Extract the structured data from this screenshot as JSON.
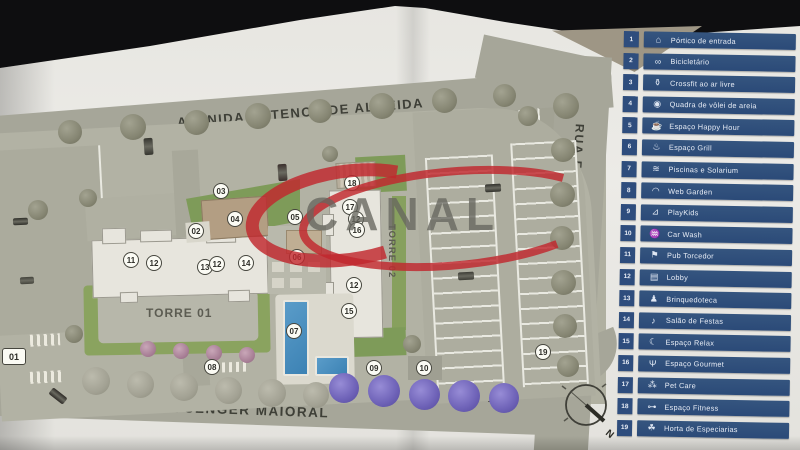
{
  "map": {
    "avenue_label": "AVENIDA ANTENOR DE ALMEIDA",
    "right_street_label": "RUA FIORAVANTE PISSUTTO",
    "bottom_street_label": "RUA REGINA SENGER MAIORAL",
    "tower1_label": "TORRE 01",
    "tower2_label": "TORRE 02",
    "compass_label": "N",
    "markers": [
      {
        "n": "01",
        "x": 14,
        "y": 356,
        "shape": "square"
      },
      {
        "n": "02",
        "x": 196,
        "y": 231
      },
      {
        "n": "03",
        "x": 221,
        "y": 191
      },
      {
        "n": "04",
        "x": 235,
        "y": 219
      },
      {
        "n": "05",
        "x": 295,
        "y": 217
      },
      {
        "n": "06",
        "x": 297,
        "y": 257
      },
      {
        "n": "07",
        "x": 294,
        "y": 331
      },
      {
        "n": "08",
        "x": 212,
        "y": 367
      },
      {
        "n": "09",
        "x": 374,
        "y": 368
      },
      {
        "n": "10",
        "x": 424,
        "y": 368
      },
      {
        "n": "11",
        "x": 131,
        "y": 260
      },
      {
        "n": "12",
        "x": 154,
        "y": 263
      },
      {
        "n": "13",
        "x": 205,
        "y": 267
      },
      {
        "n": "12",
        "x": 217,
        "y": 264
      },
      {
        "n": "14",
        "x": 246,
        "y": 263
      },
      {
        "n": "18",
        "x": 352,
        "y": 183
      },
      {
        "n": "17",
        "x": 350,
        "y": 207
      },
      {
        "n": "12",
        "x": 356,
        "y": 219
      },
      {
        "n": "16",
        "x": 357,
        "y": 230
      },
      {
        "n": "12",
        "x": 354,
        "y": 285
      },
      {
        "n": "15",
        "x": 349,
        "y": 311
      },
      {
        "n": "19",
        "x": 543,
        "y": 352
      }
    ]
  },
  "watermark": {
    "text": "CANAL",
    "swoosh_color": "#c1272d",
    "text_color": "#67675f"
  },
  "legend": {
    "items": [
      {
        "num": "1",
        "label": "Pórtico de entrada",
        "icon": "⌂",
        "icon_name": "entrance-gate-icon"
      },
      {
        "num": "2",
        "label": "Bicicletário",
        "icon": "∞",
        "icon_name": "bicycle-icon"
      },
      {
        "num": "3",
        "label": "Crossfit ao ar livre",
        "icon": "⚱",
        "icon_name": "kettlebell-icon"
      },
      {
        "num": "4",
        "label": "Quadra de vôlei de areia",
        "icon": "◉",
        "icon_name": "volleyball-icon"
      },
      {
        "num": "5",
        "label": "Espaço Happy Hour",
        "icon": "☕",
        "icon_name": "happy-hour-icon"
      },
      {
        "num": "6",
        "label": "Espaço Grill",
        "icon": "♨",
        "icon_name": "grill-icon"
      },
      {
        "num": "7",
        "label": "Piscinas e Solarium",
        "icon": "≋",
        "icon_name": "pool-icon"
      },
      {
        "num": "8",
        "label": "Web Garden",
        "icon": "◠",
        "icon_name": "wifi-icon"
      },
      {
        "num": "9",
        "label": "PlayKids",
        "icon": "⊿",
        "icon_name": "playground-slide-icon"
      },
      {
        "num": "10",
        "label": "Car Wash",
        "icon": "♒",
        "icon_name": "car-wash-icon"
      },
      {
        "num": "11",
        "label": "Pub Torcedor",
        "icon": "⚑",
        "icon_name": "sports-pub-icon"
      },
      {
        "num": "12",
        "label": "Lobby",
        "icon": "▤",
        "icon_name": "lobby-icon"
      },
      {
        "num": "13",
        "label": "Brinquedoteca",
        "icon": "♟",
        "icon_name": "toy-room-icon"
      },
      {
        "num": "14",
        "label": "Salão de Festas",
        "icon": "♪",
        "icon_name": "party-hall-icon"
      },
      {
        "num": "15",
        "label": "Espaço Relax",
        "icon": "☾",
        "icon_name": "relax-icon"
      },
      {
        "num": "16",
        "label": "Espaço Gourmet",
        "icon": "Ψ",
        "icon_name": "gourmet-icon"
      },
      {
        "num": "17",
        "label": "Pet Care",
        "icon": "⁂",
        "icon_name": "pet-care-icon"
      },
      {
        "num": "18",
        "label": "Espaço Fitness",
        "icon": "⊶",
        "icon_name": "dumbbell-icon"
      },
      {
        "num": "19",
        "label": "Horta de Especiarias",
        "icon": "☘",
        "icon_name": "herb-garden-icon"
      }
    ]
  }
}
